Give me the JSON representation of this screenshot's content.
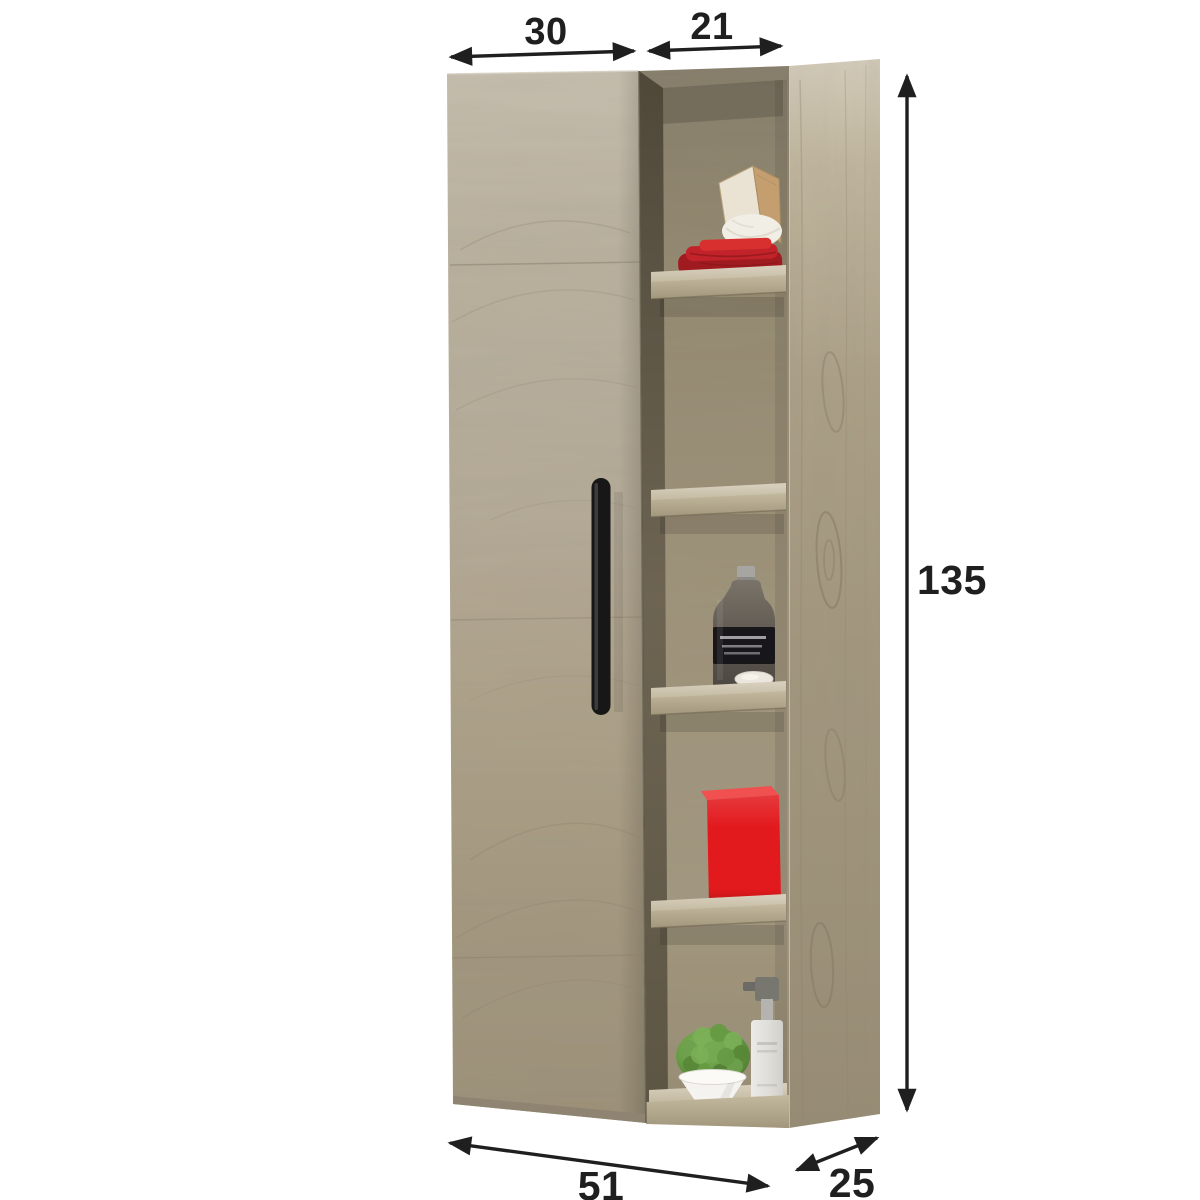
{
  "canvas": {
    "width": 1200,
    "height": 1200,
    "background": "#ffffff"
  },
  "diagram": {
    "type": "furniture-dimension-diagram",
    "subject": "wall-hung bathroom cabinet with one door and open shelf column",
    "annotations": {
      "color": "#222222",
      "dims": {
        "door_width": "30",
        "shelf_width": "21",
        "height": "135",
        "total_width": "51",
        "depth": "25"
      }
    },
    "cabinet": {
      "colors": {
        "door_wood": "#b5ab99",
        "side_wood": "#a69b82",
        "interior_wood": "#958b74",
        "shelf_wood": "#cdc4af",
        "handle": "#171717"
      },
      "shelf_items": [
        {
          "name": "wooden-board",
          "color": "#c49e6e"
        },
        {
          "name": "white-towel-roll",
          "color": "#f1eee6"
        },
        {
          "name": "folded-red-towels",
          "color": "#c2232a"
        },
        {
          "name": "dark-glass-bottle",
          "color": "#5b5650"
        },
        {
          "name": "soap-bar",
          "color": "#ebe7de"
        },
        {
          "name": "red-storage-box",
          "color": "#e2191d"
        },
        {
          "name": "potted-plant",
          "leaf_color": "#6fa14e",
          "pot_color": "#f4f3ef"
        },
        {
          "name": "soap-dispenser",
          "color": "#e4e3df"
        }
      ]
    }
  }
}
